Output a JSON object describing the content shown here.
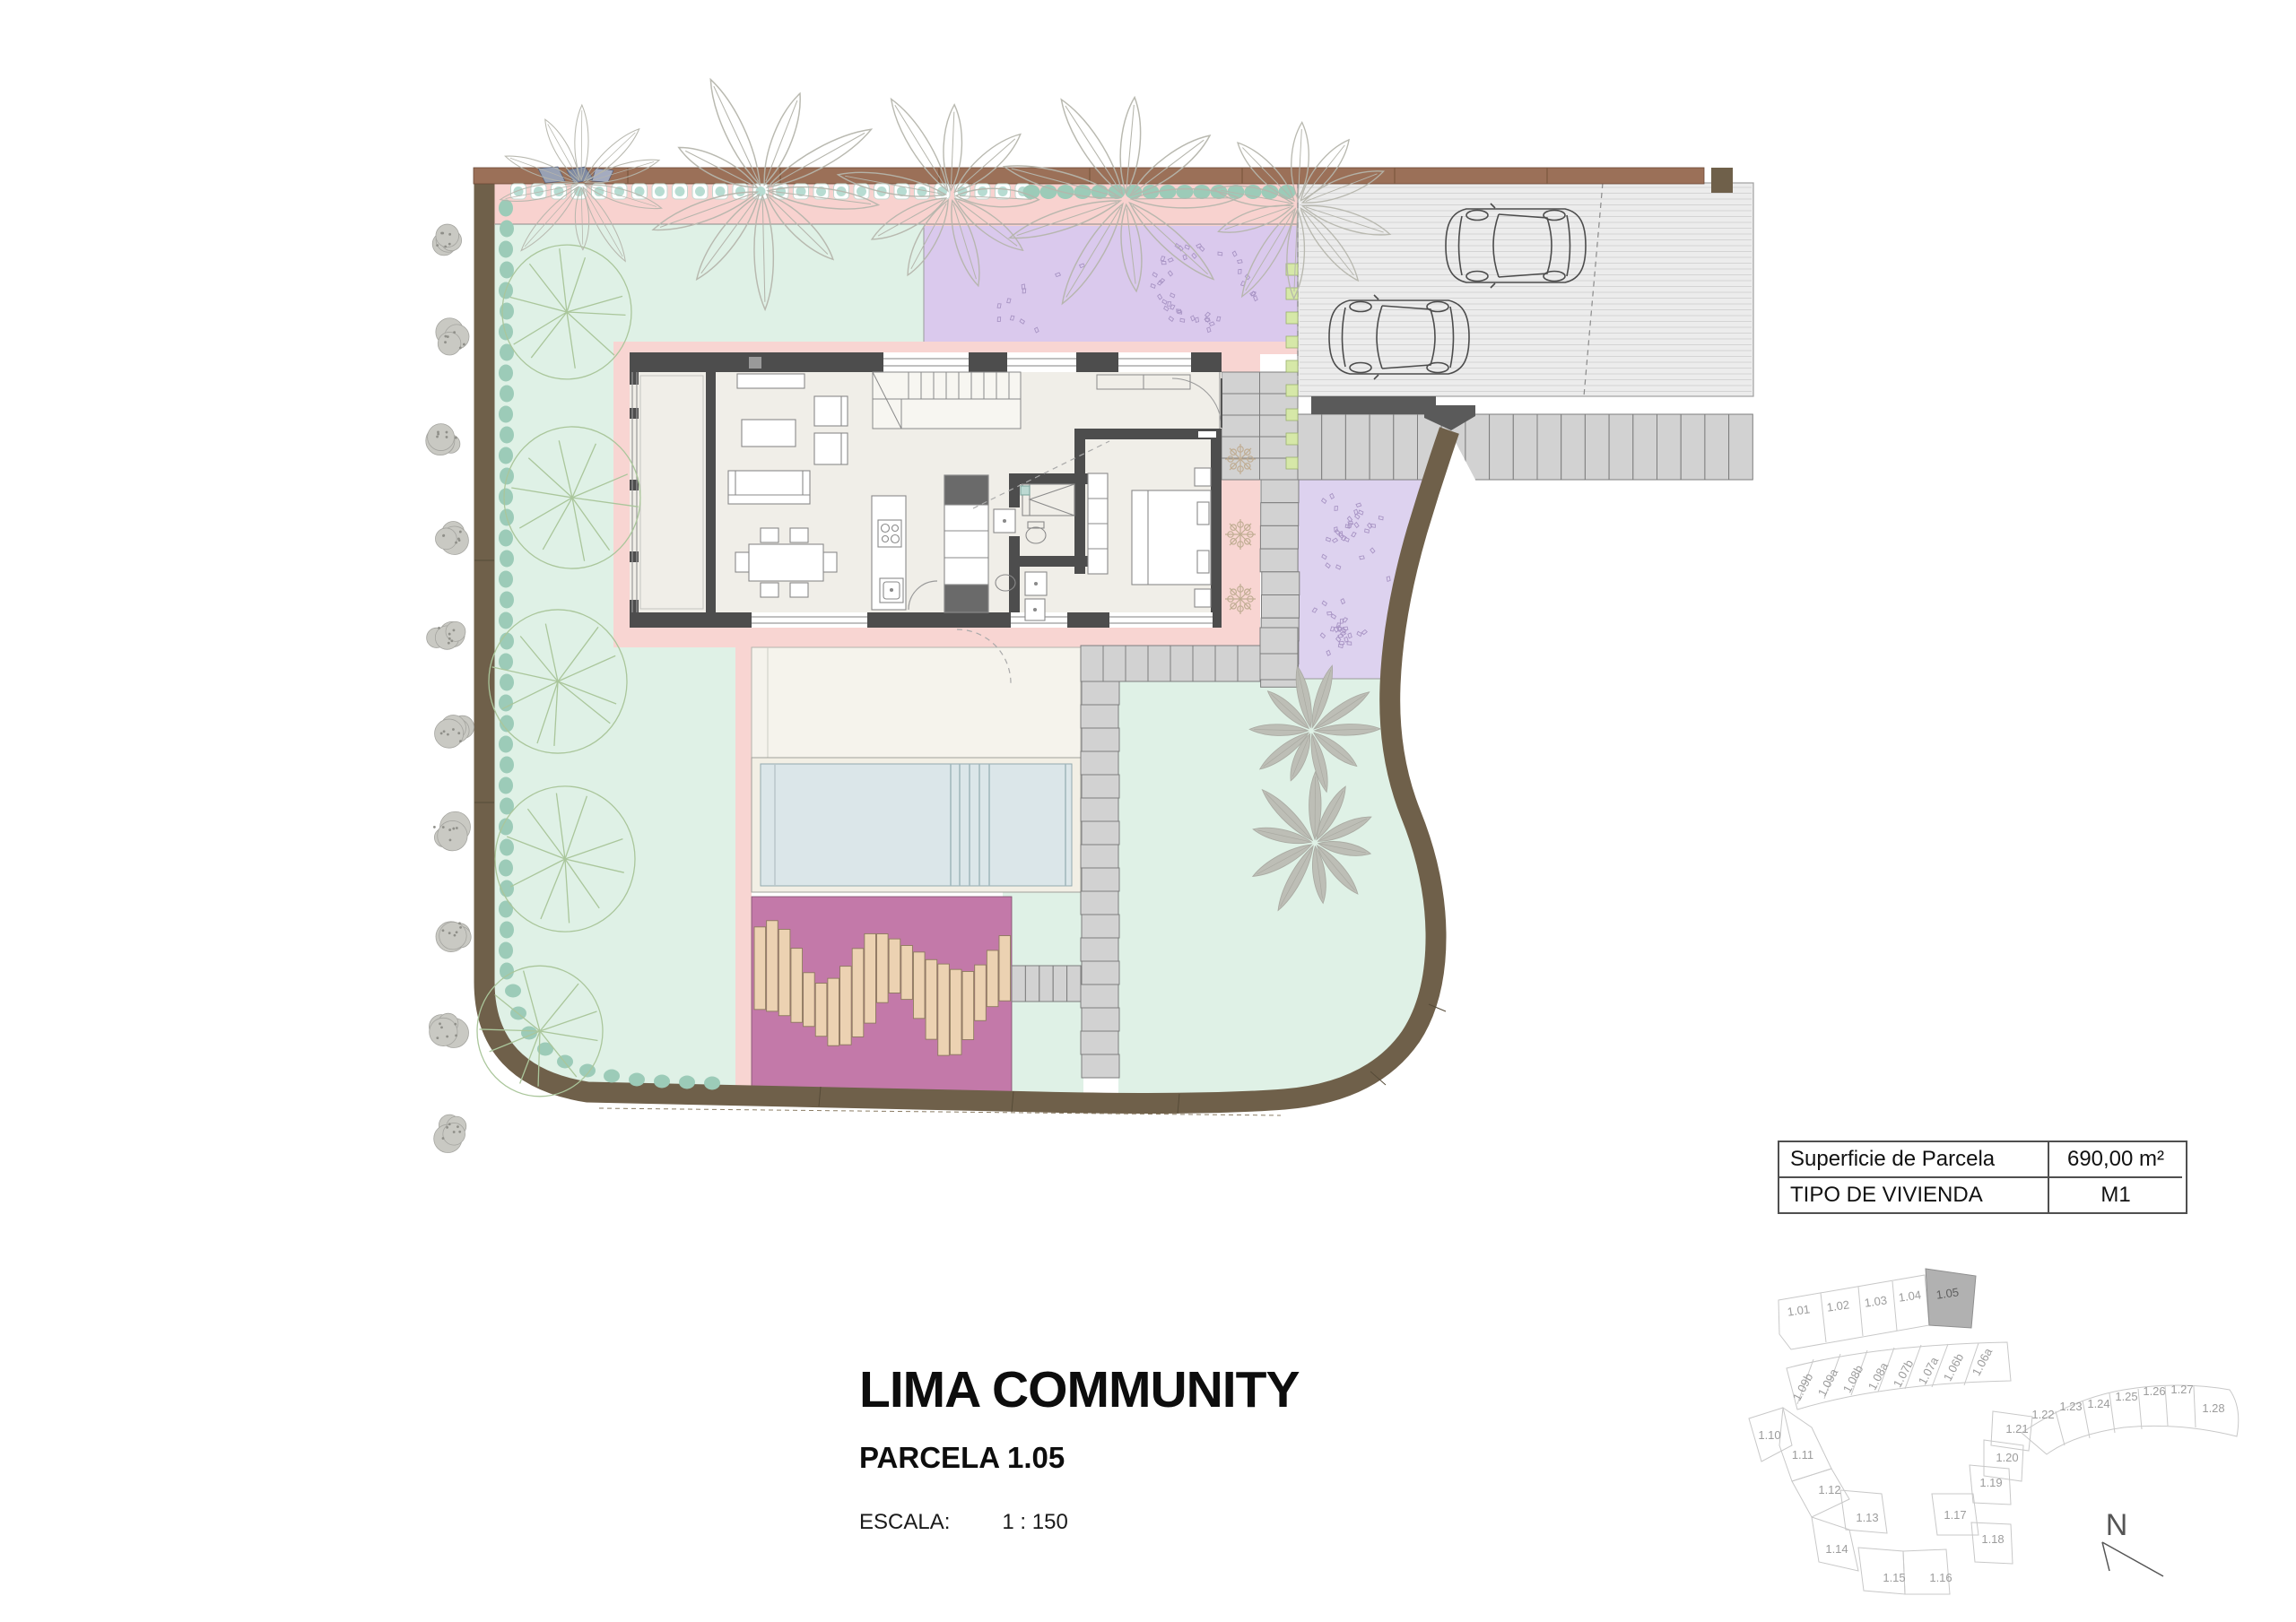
{
  "doc": {
    "title": "LIMA COMMUNITY",
    "subtitle": "PARCELA 1.05",
    "scale_label": "ESCALA:",
    "scale_value": "1 : 150"
  },
  "info_table": {
    "rows": [
      {
        "label": "Superficie de Parcela",
        "value": "690,00 m²"
      },
      {
        "label": "TIPO DE VIVIENDA",
        "value": "M1"
      }
    ]
  },
  "keyplan": {
    "highlighted_parcel": "1.05",
    "north_label": "N",
    "parcels": [
      "1.01",
      "1.02",
      "1.03",
      "1.04",
      "1.05",
      "1.09b",
      "1.09a",
      "1.08b",
      "1.08a",
      "1.07b",
      "1.07a",
      "1.06b",
      "1.06a",
      "1.10",
      "1.11",
      "1.12",
      "1.13",
      "1.14",
      "1.15",
      "1.16",
      "1.17",
      "1.18",
      "1.19",
      "1.20",
      "1.21",
      "1.22",
      "1.23",
      "1.24",
      "1.25",
      "1.26",
      "1.27",
      "1.28"
    ]
  },
  "colors": {
    "lawn": "#dff1e6",
    "terrace_pink": "#f8d5d2",
    "purple_garden": "#dac9ed",
    "magenta_deck": "#c379a9",
    "boundary_wall": "#6f604a",
    "street_wall": "#9b7058",
    "pool_water": "#dbe6e9",
    "paver_gray": "#d2d2d2",
    "hedge_teal": "#9ccbb8",
    "plank_tan": "#ecd2b2",
    "keyplan_highlight": "#b1b1b1"
  }
}
